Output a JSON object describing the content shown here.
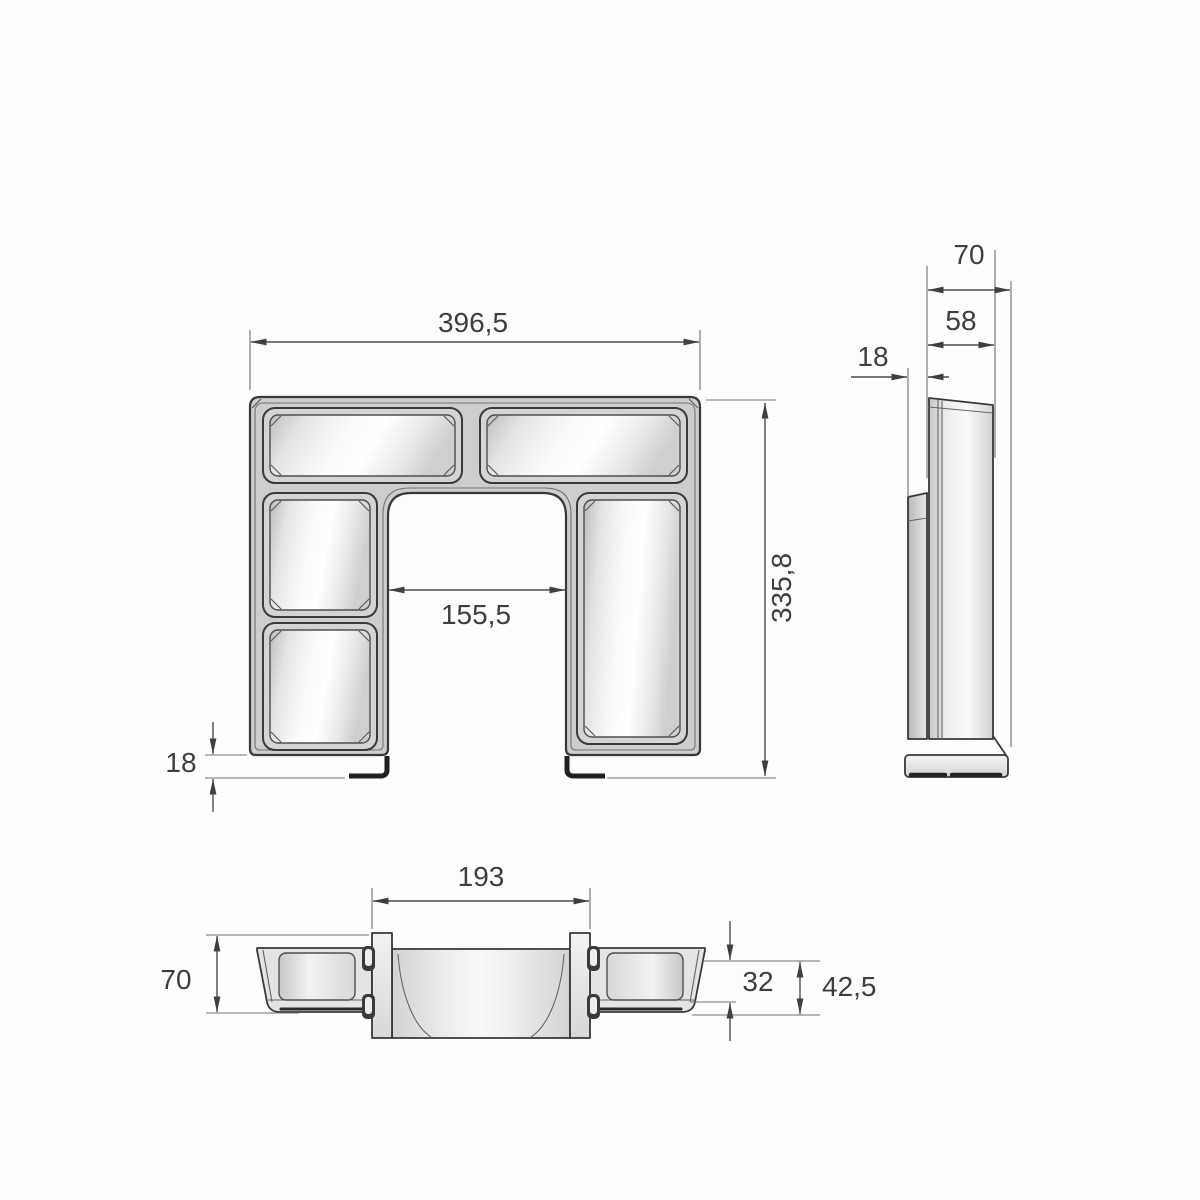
{
  "page": {
    "background": "#fdfdfd"
  },
  "drawing": {
    "type": "technical-drawing-three-views",
    "views": {
      "front": {
        "name": "front-view",
        "dims": {
          "overall_width": "396,5",
          "overall_height": "335,8",
          "opening_width": "155,5",
          "foot_height": "18"
        }
      },
      "side": {
        "name": "side-view",
        "dims": {
          "total_depth": "70",
          "front_depth": "58",
          "back_offset": "18"
        }
      },
      "bottom": {
        "name": "bottom-view",
        "dims": {
          "channel_width": "193",
          "total_height": "70",
          "inner_height": "32",
          "outer_height": "42,5"
        }
      }
    },
    "colors": {
      "accent": "#b0545c",
      "line": "#3c3c3c",
      "fill_light": "#f7f7f7",
      "fill_mid": "#cdcdcd"
    }
  }
}
